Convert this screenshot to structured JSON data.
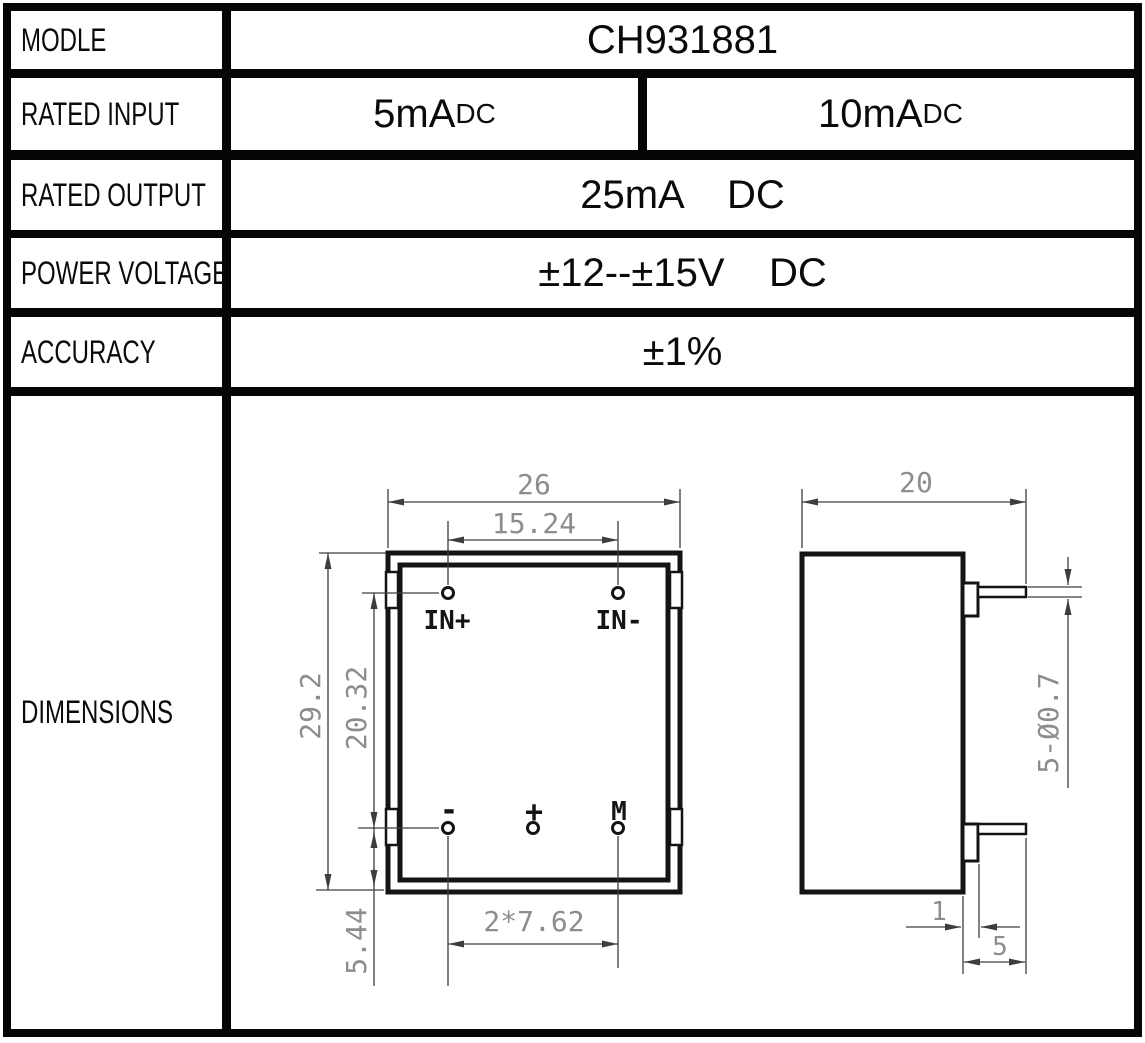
{
  "table": {
    "rows": [
      {
        "label": "MODLE",
        "value": "CH931881"
      },
      {
        "label": "RATED INPUT",
        "cells": [
          {
            "main": "5mA",
            "sub": "DC"
          },
          {
            "main": "10mA",
            "sub": "DC"
          }
        ]
      },
      {
        "label": "RATED OUTPUT",
        "value": "25mA    DC"
      },
      {
        "label": "POWER VOLTAGE",
        "value": "±12--±15V    DC"
      },
      {
        "label": "ACCURACY",
        "value": "±1%"
      },
      {
        "label": "DIMENSIONS"
      }
    ]
  },
  "drawing": {
    "front_view": {
      "body_width": "26",
      "top_pin_pitch": "15.24",
      "body_height": "29.2",
      "pin_rows_span": "20.32",
      "pin_row_to_bottom": "5.44",
      "bottom_pin_pitch": "2*7.62",
      "pins_top": [
        "IN+",
        "IN-"
      ],
      "pins_bottom": [
        "-",
        "+",
        "M"
      ]
    },
    "side_view": {
      "body_depth": "20",
      "pin_spec": "5-Ø0.7",
      "pin_step": "1",
      "pin_length": "5"
    }
  },
  "colors": {
    "border": "#050505",
    "object_line": "#141414",
    "dimension_line": "#3d3d3d",
    "dimension_text": "#8d8d8d",
    "background": "#ffffff"
  }
}
